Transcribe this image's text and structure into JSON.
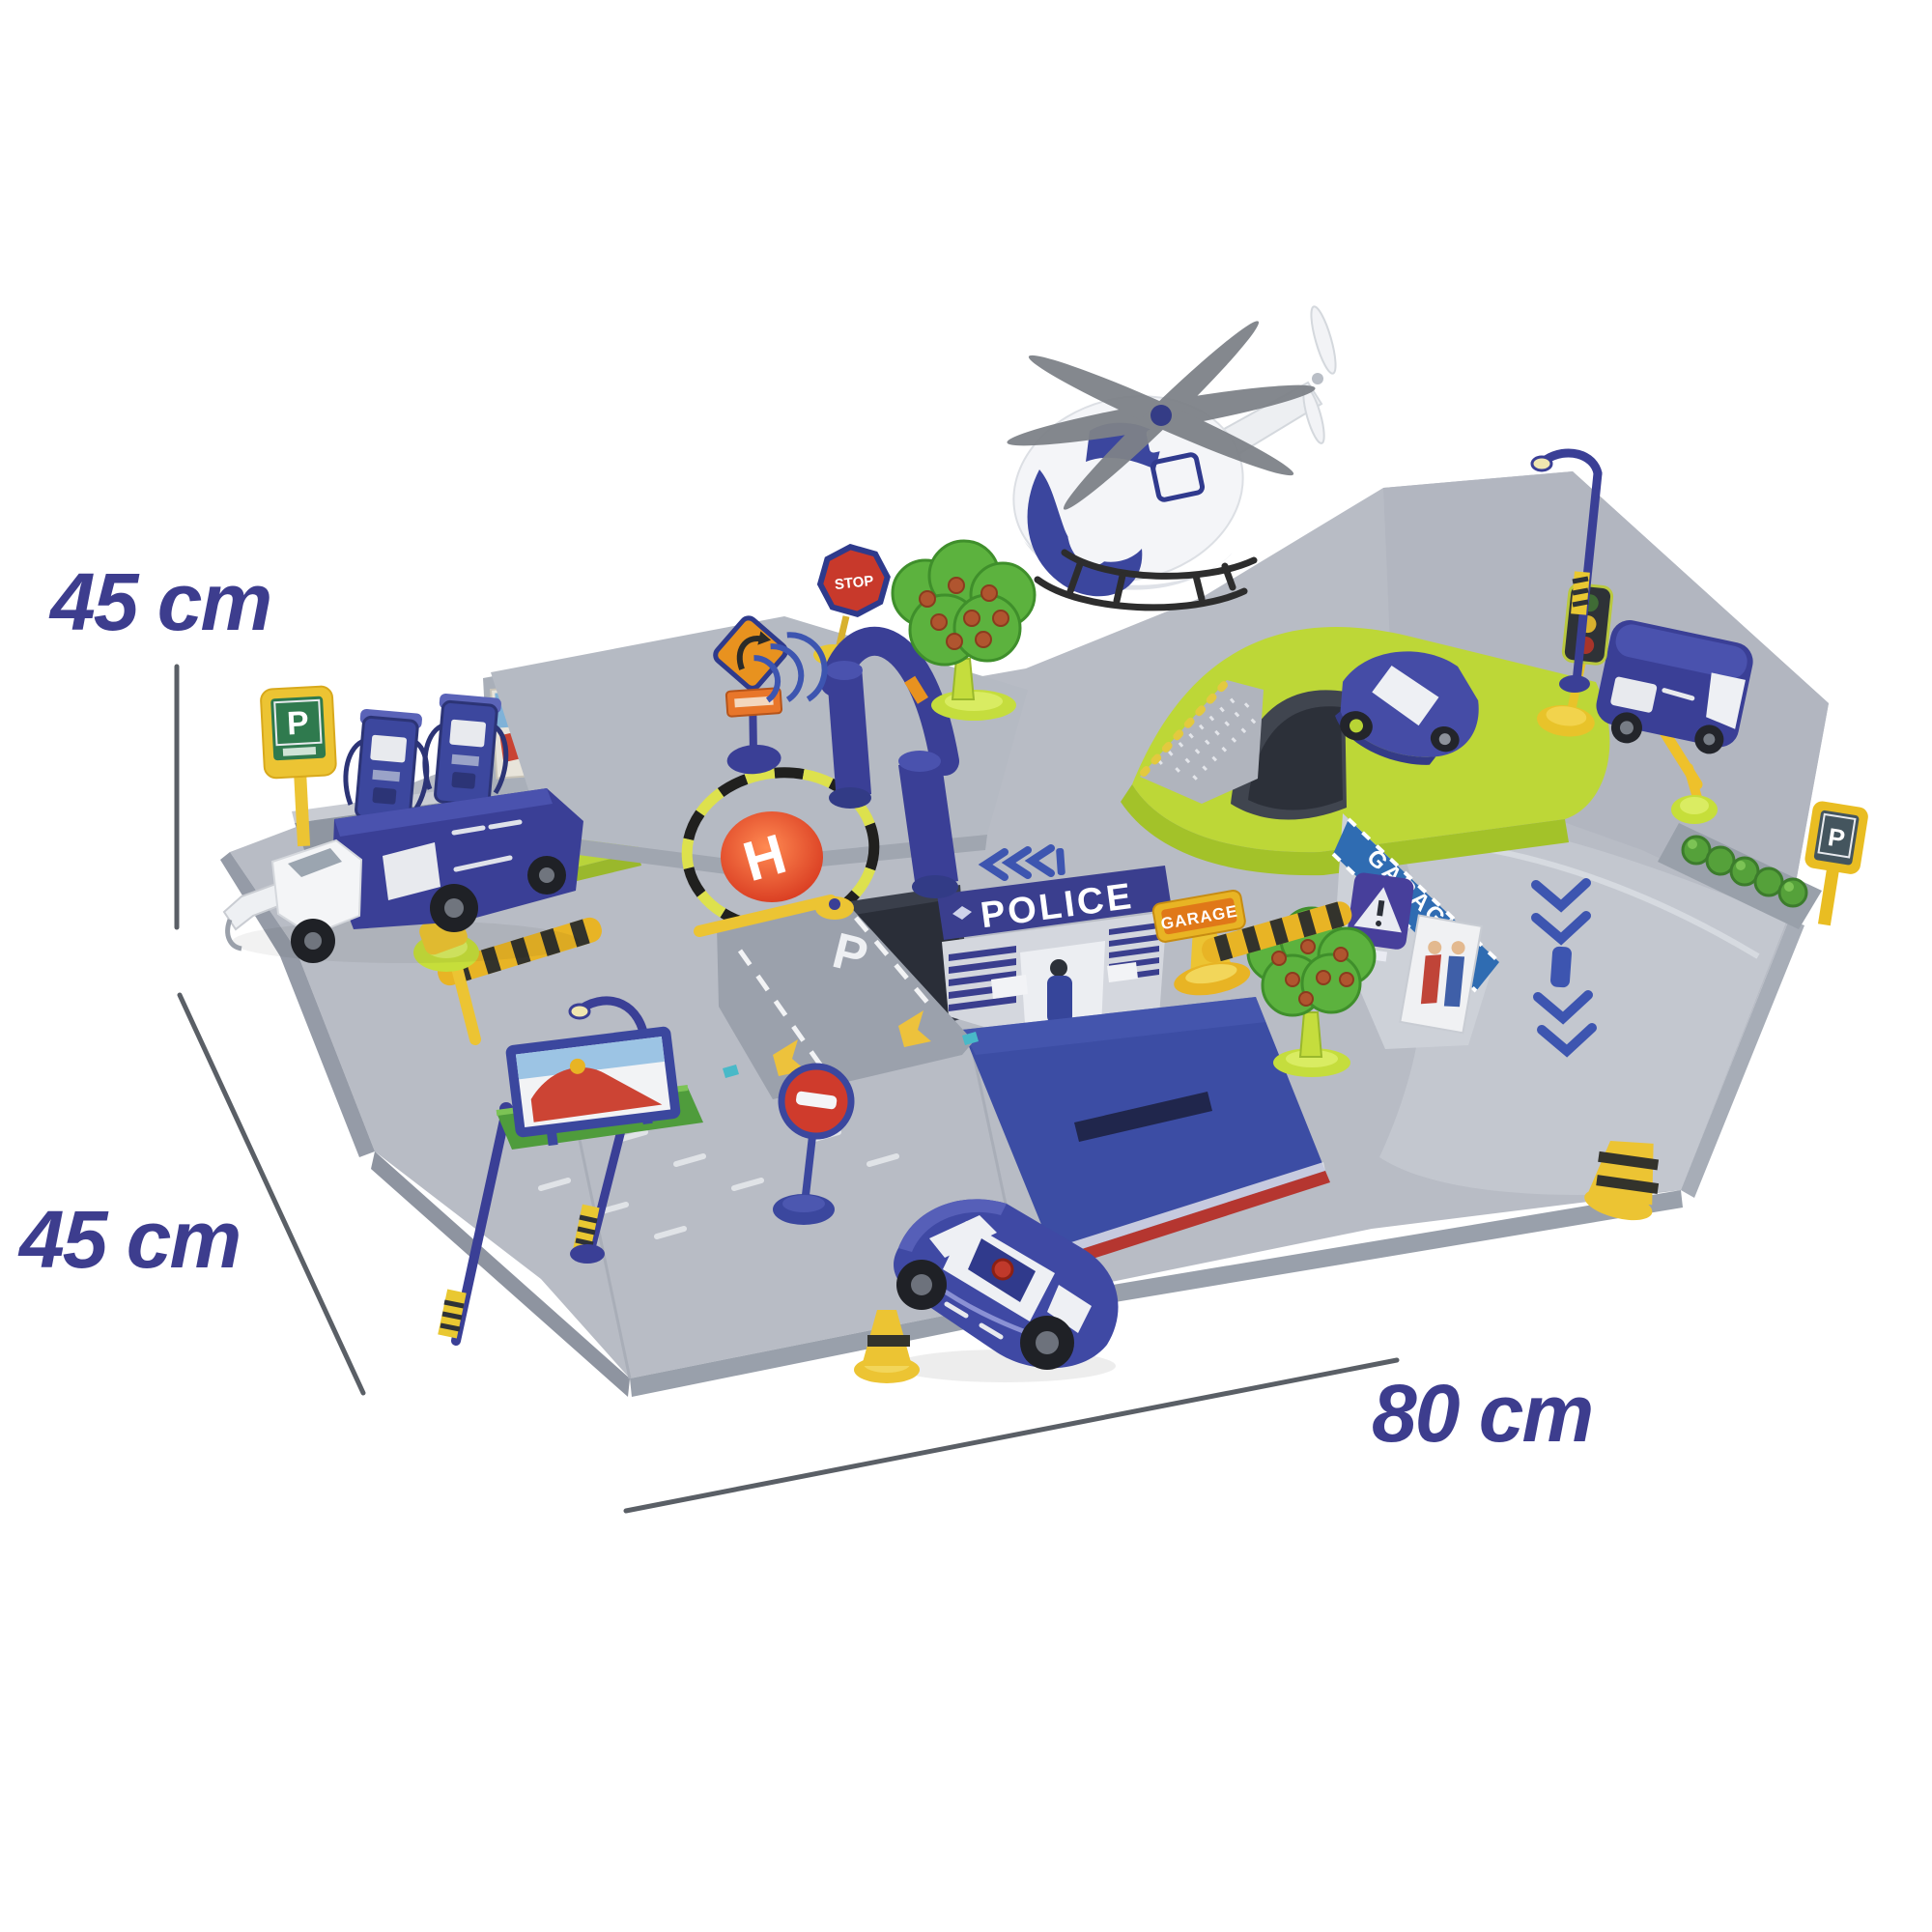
{
  "meta": {
    "kind": "product-photo",
    "background_color": "#ffffff",
    "subject": "toy police station parking garage playset with helicopter, cars and road signs, annotated with dimensions"
  },
  "annotations": {
    "height_label": "45 cm",
    "depth_label": "45 cm",
    "width_label": "80 cm",
    "label_color": "#3d3d8e",
    "line_color": "#5a5f66"
  },
  "playset": {
    "texts": {
      "police_banner": "POLICE",
      "helipad_letter": "H",
      "fuel_parking_sign": "P",
      "road_parking_marking": "P",
      "right_parking_sign": "P",
      "garage_sign": "GARAGE",
      "garage_wall_banner": "GARAGE",
      "stop_sign": "STOP"
    },
    "colors": {
      "base_gray": "#b8bcc5",
      "navy_blue": "#3a3f96",
      "royal_blue": "#3c4da4",
      "banner_blue": "#2f6cb2",
      "lime_green": "#bdd737",
      "grass_green": "#55a13a",
      "yellow": "#ecc433",
      "orange": "#e8921f",
      "red": "#cf3b2c",
      "teal": "#3fc0ce",
      "white": "#ffffff"
    },
    "elements": [
      "helicopter",
      "helipad",
      "police-station",
      "garage-opening",
      "blue-ramp",
      "green-bridge",
      "tunnel",
      "bumpy-ramp",
      "sports-car",
      "police-car",
      "police-van",
      "tow-truck",
      "fuel-pumps",
      "parking-signs",
      "traffic-light",
      "street-lamps",
      "stop-sign",
      "no-entry-sign",
      "curve-warning-sign",
      "garage-signs",
      "billboard",
      "apple-trees",
      "speed-bumps",
      "barrier-gates",
      "traffic-cones",
      "hedge",
      "arch-gate"
    ]
  }
}
